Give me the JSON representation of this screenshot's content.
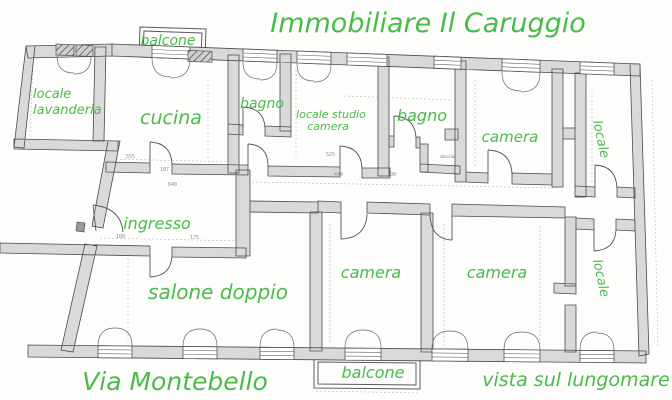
{
  "title": "Immobiliare Il Caruggio",
  "balconies": {
    "top": "balcone",
    "bottom": "balcone"
  },
  "rooms": {
    "lavanderia_line1": "locale",
    "lavanderia_line2": "lavanderia",
    "cucina": "cucina",
    "bagno_small": "bagno",
    "studio_line1": "locale studio",
    "studio_line2": "camera",
    "bagno": "bagno",
    "camera_top": "camera",
    "locale_top": "locale",
    "ingresso": "ingresso",
    "salone": "salone doppio",
    "camera_left": "camera",
    "camera_right": "camera",
    "locale_bottom": "locale",
    "doccia": "doccia"
  },
  "streets": {
    "front": "Via Montebello",
    "rear_view": "vista sul lungomare"
  },
  "dimensions": [
    "555",
    "107",
    "640",
    "100",
    "175",
    "444",
    "525",
    "90"
  ],
  "colors": {
    "label_green": "#49bb49",
    "wall_fill": "#d9d9d9",
    "wall_stroke": "#4a4a4a",
    "paper": "#fdfdfc"
  }
}
